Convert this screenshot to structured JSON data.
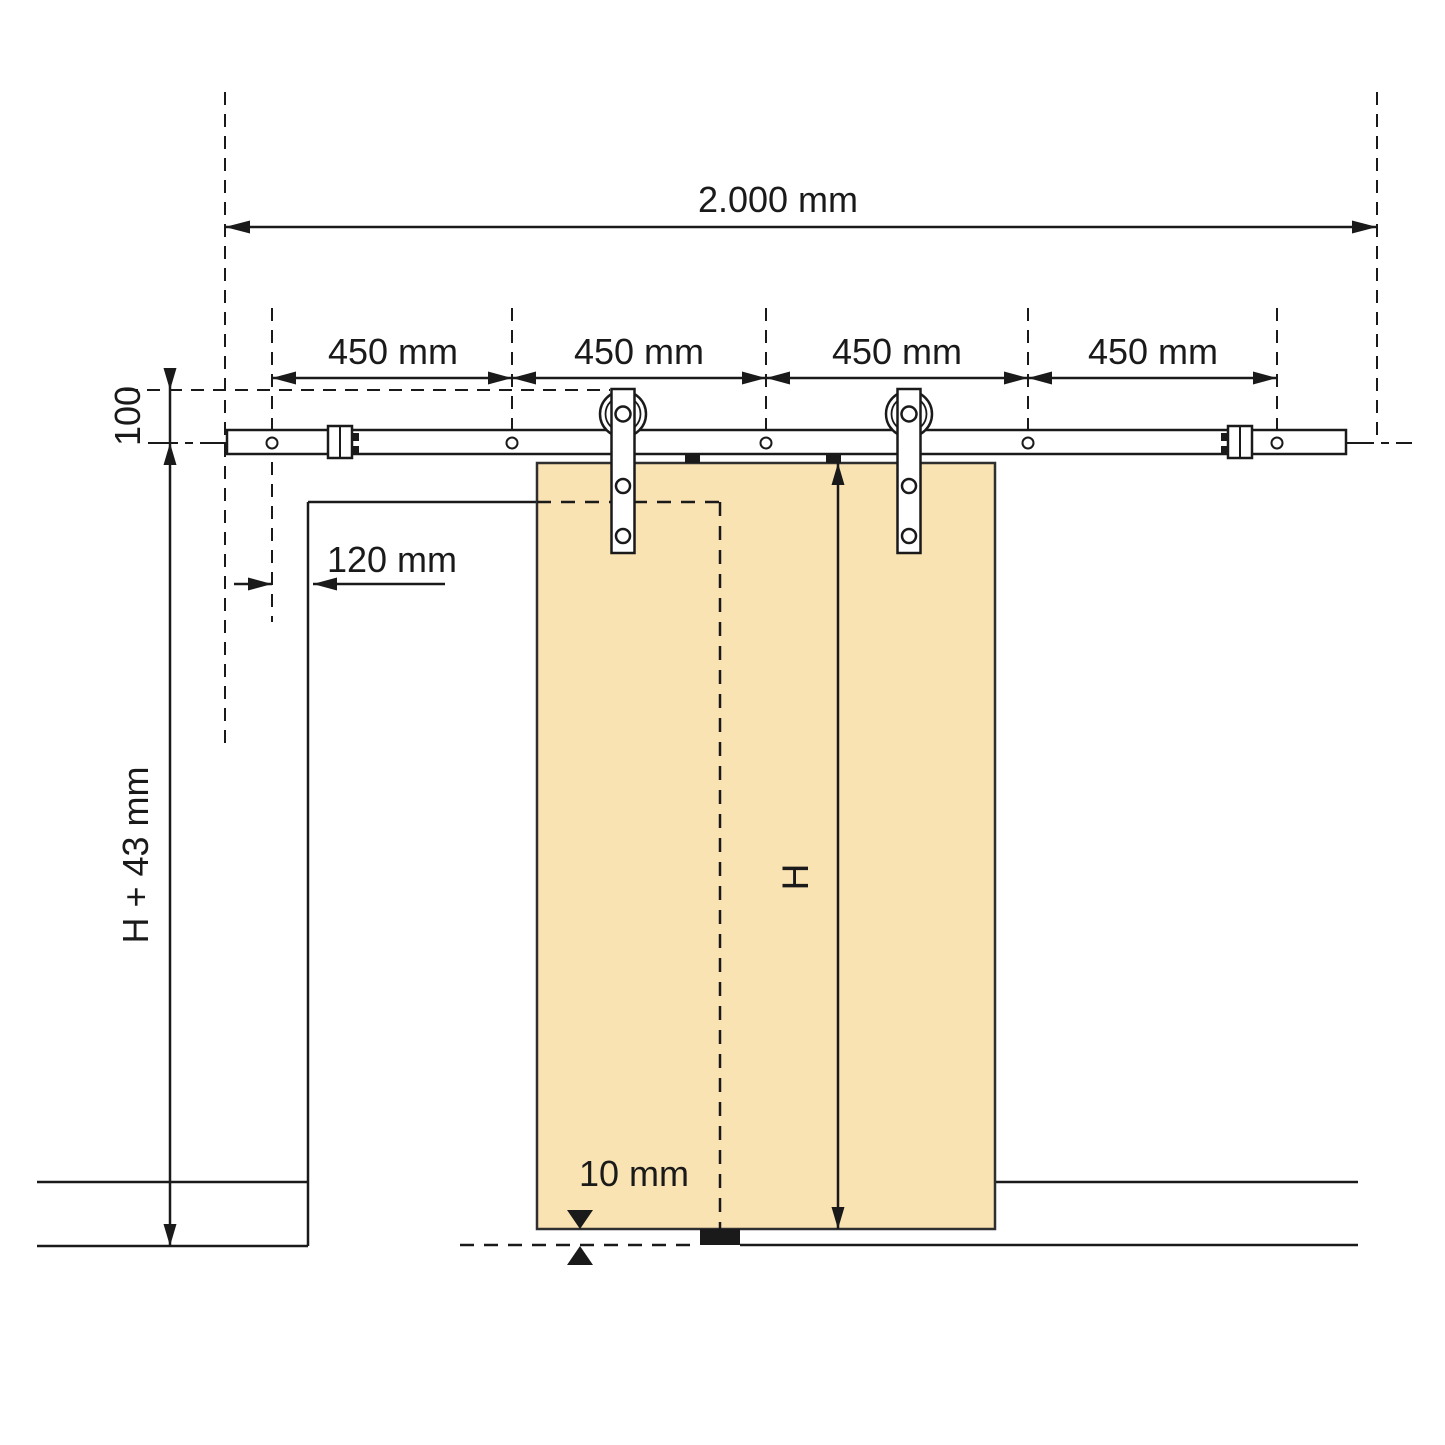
{
  "title": "Sliding barn-door track installation drawing",
  "colors": {
    "background": "#FFFFFF",
    "line": "#1A1A1A",
    "door_fill": "#FAE3B2",
    "hardware_fill": "#FFFFFF"
  },
  "labels": {
    "track_length": "2.000 mm",
    "spacing_1": "450 mm",
    "spacing_2": "450 mm",
    "spacing_3": "450 mm",
    "spacing_4": "450 mm",
    "rail_axis_height": "100",
    "first_hole_offset": "120 mm",
    "total_height": "H + 43 mm",
    "door_height": "H",
    "floor_gap": "10 mm"
  }
}
